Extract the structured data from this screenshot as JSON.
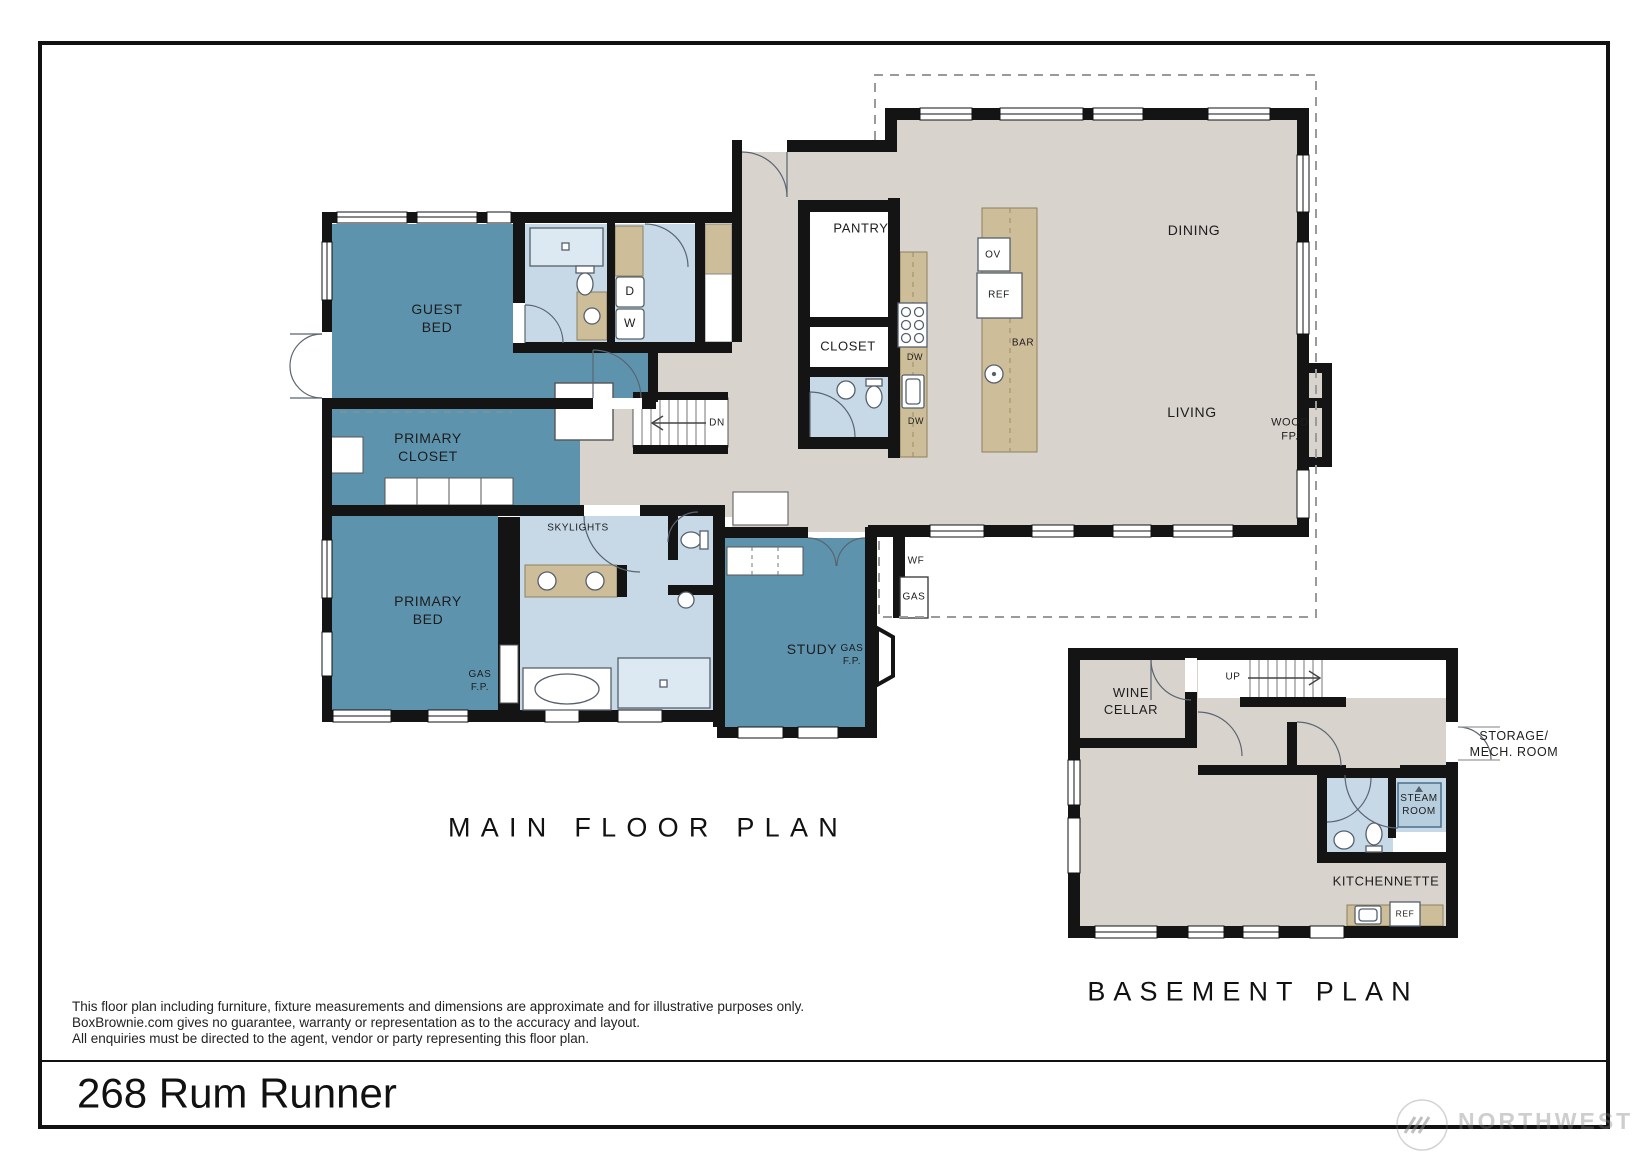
{
  "document": {
    "address": "268 Rum Runner",
    "disclaimer": [
      "This floor plan including furniture, fixture measurements and dimensions are approximate and for illustrative purposes only.",
      "BoxBrownie.com gives no guarantee, warranty or representation as to the accuracy and layout.",
      "All enquiries must be directed to the agent, vendor or party representing this floor plan."
    ],
    "watermark": "NORTHWEST"
  },
  "main_floor": {
    "title": "MAIN FLOOR PLAN",
    "rooms": {
      "guest_bed": "GUEST\nBED",
      "primary_closet": "PRIMARY\nCLOSET",
      "primary_bed": "PRIMARY\nBED",
      "study": "STUDY",
      "pantry": "PANTRY",
      "closet": "CLOSET",
      "dining": "DINING",
      "living": "LIVING"
    },
    "features": {
      "wood_fp": "WOOD\nFP.",
      "gas_fp_primary": "GAS\nF.P.",
      "gas_fp_study": "GAS\nF.P.",
      "skylights": "SKYLIGHTS",
      "wf": "WF",
      "gas": "GAS",
      "dn": "DN"
    },
    "appliances": {
      "dryer": "D",
      "washer": "W",
      "dw_upper": "DW",
      "dw_lower": "DW",
      "oven": "OV",
      "fridge": "REF",
      "bar": "BAR"
    }
  },
  "basement": {
    "title": "BASEMENT PLAN",
    "rooms": {
      "wine_cellar": "WINE\nCELLAR",
      "storage_mech": "STORAGE/\nMECH. ROOM",
      "steam_room": "STEAM\nROOM",
      "kitchennette": "KITCHENNETTE"
    },
    "features": {
      "up": "UP"
    },
    "appliances": {
      "fridge": "REF"
    }
  },
  "colors": {
    "room_teal": "#5E93AE",
    "room_light_blue": "#C7D9E7",
    "shower_blue": "#DCE8F2",
    "floor_greige": "#D9D3CE",
    "counter_tan": "#CEBD99",
    "wall_black": "#141414",
    "deck_dash_gray": "#9a9a9a"
  }
}
